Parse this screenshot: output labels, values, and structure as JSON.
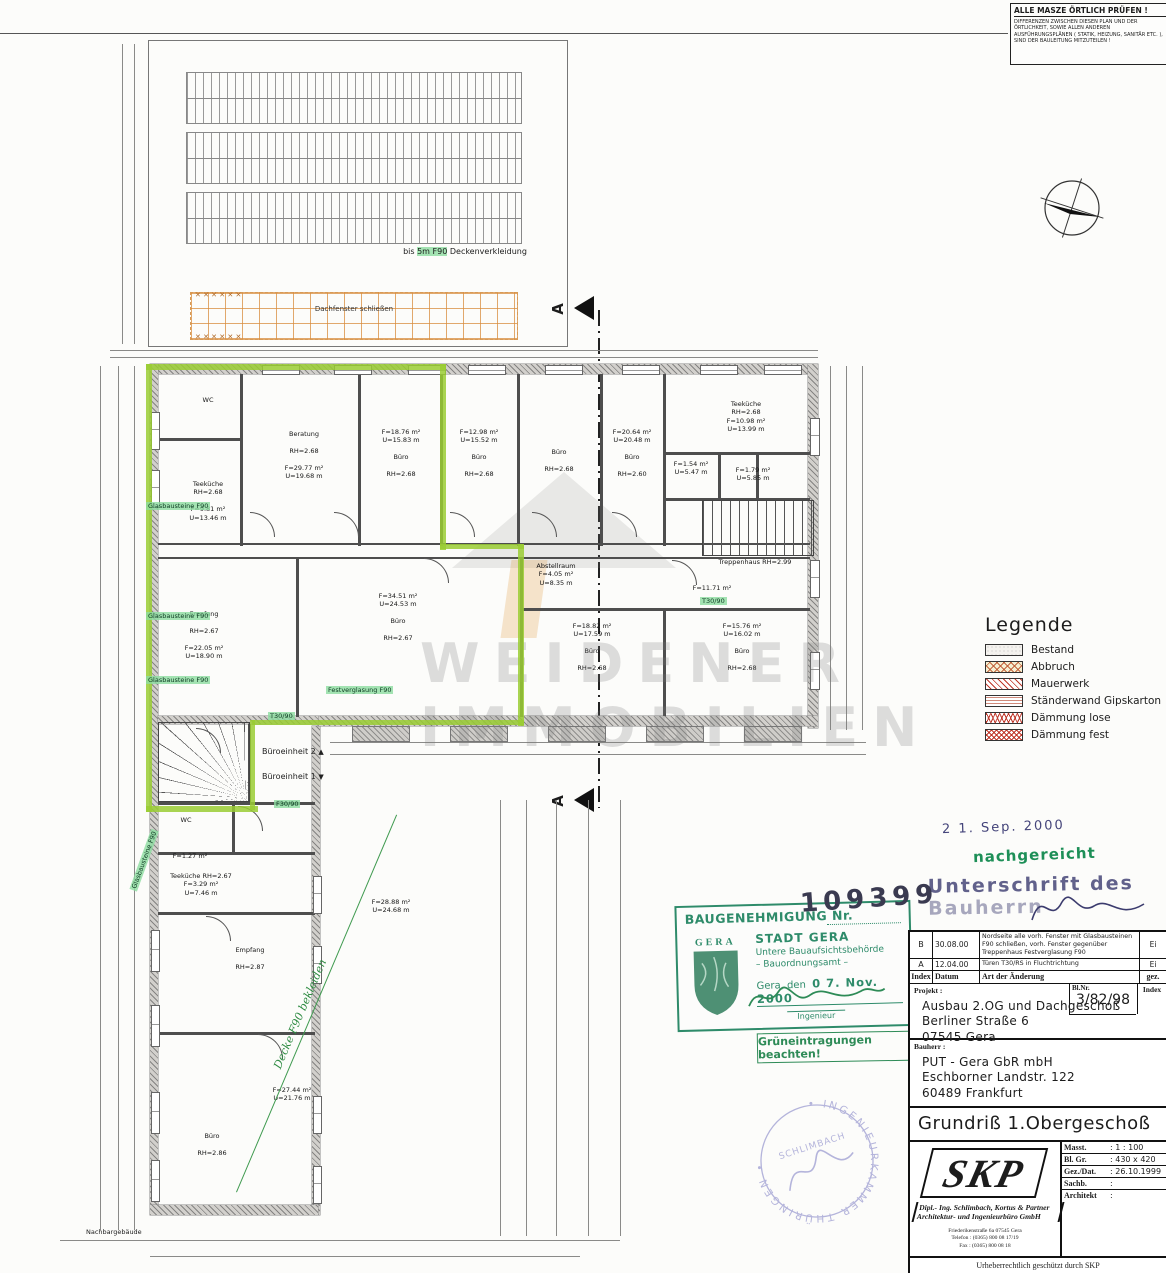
{
  "warning_box": {
    "title": "ALLE MASZE ÖRTLICH PRÜFEN !",
    "body": "DIFFERENZEN ZWISCHEN DIESEN PLAN UND DER ÖRTLICHKEIT, SOWIE ALLEN ANDEREN AUSFÜHRUNGSPLÄNEN ( STATIK, HEIZUNG, SANITÄR ETC. ), SIND DER BAULEITUNG MITZUTEILEN !"
  },
  "roof": {
    "note_pre": "bis ",
    "note_hl": "5m F90",
    "note_post": " Deckenverkleidung",
    "grid_label": "Dachfenster schließen",
    "x_row": "✕ ✕ ✕ ✕ ✕ ✕"
  },
  "section_marker": "A",
  "watermark": {
    "line1": "WEIDENER",
    "line2": "IMMOBILIEN"
  },
  "legend": {
    "title": "Legende",
    "items": [
      {
        "key": "bestand",
        "label": "Bestand"
      },
      {
        "key": "abbruch",
        "label": "Abbruch"
      },
      {
        "key": "mauerwerk",
        "label": "Mauerwerk"
      },
      {
        "key": "staender",
        "label": "Ständerwand Gipskarton"
      },
      {
        "key": "daemmlose",
        "label": "Dämmung lose"
      },
      {
        "key": "daemmfest",
        "label": "Dämmung fest"
      }
    ]
  },
  "plan": {
    "rooms": [
      {
        "x": 190,
        "y": 396,
        "w": 36,
        "lines": [
          "WC"
        ]
      },
      {
        "x": 172,
        "y": 480,
        "w": 72,
        "lines": [
          "Teeküche",
          "RH=2.68",
          "",
          "F=9.81 m²",
          "U=13.46 m"
        ]
      },
      {
        "x": 258,
        "y": 430,
        "w": 92,
        "lines": [
          "Beratung",
          "",
          "RH=2.68",
          "",
          "F=29.77 m²",
          "U=19.68 m"
        ]
      },
      {
        "x": 368,
        "y": 428,
        "w": 66,
        "lines": [
          "F=18.76 m²",
          "U=15.83 m",
          "",
          "Büro",
          "",
          "RH=2.68"
        ]
      },
      {
        "x": 446,
        "y": 428,
        "w": 66,
        "lines": [
          "F=12.98 m²",
          "U=15.52 m",
          "",
          "Büro",
          "",
          "RH=2.68"
        ]
      },
      {
        "x": 528,
        "y": 448,
        "w": 62,
        "lines": [
          "Büro",
          "",
          "RH=2.68"
        ]
      },
      {
        "x": 604,
        "y": 428,
        "w": 56,
        "lines": [
          "F=20.64 m²",
          "U=20.48 m",
          "",
          "Büro",
          "",
          "RH=2.60"
        ]
      },
      {
        "x": 700,
        "y": 400,
        "w": 92,
        "lines": [
          "Teeküche",
          "RH=2.68",
          "F=10.98 m²",
          "U=13.99 m"
        ]
      },
      {
        "x": 668,
        "y": 460,
        "w": 46,
        "lines": [
          "F=1.54 m²",
          "U=5.47 m"
        ]
      },
      {
        "x": 728,
        "y": 466,
        "w": 50,
        "lines": [
          "F=1.79 m²",
          "U=5.85 m"
        ]
      },
      {
        "x": 700,
        "y": 558,
        "w": 110,
        "lines": [
          "Treppenhaus   RH=2.99"
        ]
      },
      {
        "x": 680,
        "y": 584,
        "w": 64,
        "lines": [
          "F=11.71 m²"
        ]
      },
      {
        "x": 516,
        "y": 562,
        "w": 80,
        "lines": [
          "Abstellraum",
          "F=4.05 m²",
          "U=8.35 m"
        ]
      },
      {
        "x": 162,
        "y": 610,
        "w": 84,
        "lines": [
          "Empfang",
          "",
          "RH=2.67",
          "",
          "F=22.05 m²",
          "U=18.90 m"
        ]
      },
      {
        "x": 352,
        "y": 592,
        "w": 92,
        "lines": [
          "F=34.51 m²",
          "U=24.53 m",
          "",
          "Büro",
          "",
          "RH=2.67"
        ]
      },
      {
        "x": 552,
        "y": 622,
        "w": 80,
        "lines": [
          "F=18.82 m²",
          "U=17.59 m",
          "",
          "Büro",
          "",
          "RH=2.68"
        ]
      },
      {
        "x": 700,
        "y": 622,
        "w": 84,
        "lines": [
          "F=15.76 m²",
          "U=16.02 m",
          "",
          "Büro",
          "",
          "RH=2.68"
        ]
      },
      {
        "x": 168,
        "y": 816,
        "w": 36,
        "lines": [
          "WC"
        ]
      },
      {
        "x": 162,
        "y": 852,
        "w": 56,
        "lines": [
          "F=1.27 m²"
        ]
      },
      {
        "x": 158,
        "y": 872,
        "w": 86,
        "lines": [
          "Teeküche  RH=2.67",
          "F=3.29 m²",
          "U=7.46 m"
        ]
      },
      {
        "x": 352,
        "y": 898,
        "w": 78,
        "lines": [
          "F=28.88 m²",
          "U=24.68 m"
        ]
      },
      {
        "x": 212,
        "y": 946,
        "w": 76,
        "lines": [
          "Empfang",
          "",
          "RH=2.87"
        ]
      },
      {
        "x": 252,
        "y": 1086,
        "w": 80,
        "lines": [
          "F=27.44 m²",
          "U=21.76 m"
        ]
      },
      {
        "x": 182,
        "y": 1132,
        "w": 60,
        "lines": [
          "Büro",
          "",
          "RH=2.86"
        ]
      }
    ],
    "green_notes": [
      {
        "x": 146,
        "y": 502,
        "t": "Glasbausteine F90"
      },
      {
        "x": 146,
        "y": 612,
        "t": "Glasbausteine F90"
      },
      {
        "x": 146,
        "y": 676,
        "t": "Glasbausteine F90"
      },
      {
        "x": 326,
        "y": 686,
        "t": "Festverglasung F90"
      },
      {
        "x": 268,
        "y": 712,
        "t": "T30/90"
      },
      {
        "x": 700,
        "y": 597,
        "t": "T30/90"
      },
      {
        "x": 274,
        "y": 800,
        "t": "F30/90"
      },
      {
        "x": 112,
        "y": 856,
        "t": "Glasbausteine F90",
        "rot": -70
      }
    ],
    "unit_labels": [
      {
        "label": "Büroeinheit 2",
        "arrow": "▲",
        "x": 262,
        "y": 747
      },
      {
        "label": "Büroeinheit 1",
        "arrow": "▼",
        "x": 262,
        "y": 772
      }
    ],
    "diag_note": "Decke F90 bekleiden",
    "neighbor_label": "Nachbargebäude"
  },
  "stamps": {
    "date_received": "2 1. Sep. 2000",
    "nachgereicht": "nachgereicht",
    "unterschrift_line1": "Unterschrift des",
    "unterschrift_line2": "Bauherrn",
    "baugenehmigung": {
      "title": "BAUGENEHMIGUNG Nr.",
      "number": "109399",
      "shield_caption": "G E R A",
      "line1": "STADT GERA",
      "line2": "Untere Bauaufsichtsbehörde",
      "line3": "– Bauordnungsamt –",
      "date_prefix": "Gera, den",
      "date": "0 7. Nov. 2000",
      "role": "Ingenieur"
    },
    "gruen_note": "Grüneintragungen beachten!",
    "seal_ring": "INGENIEURKAMMER THÜRINGEN",
    "seal_name": "SCHLIMBACH"
  },
  "revision": {
    "rows": [
      {
        "index": "B",
        "datum": "30.08.00",
        "text": "Nordseite alle vorh. Fenster mit Glasbausteinen F90 schließen, vorh. Fenster gegenüber Treppenhaus Festverglasung F90",
        "gez": "Ei"
      },
      {
        "index": "A",
        "datum": "12.04.00",
        "text": "Türen T30/RS in Fluchtrichtung",
        "gez": "Ei"
      }
    ],
    "header": {
      "index": "Index",
      "datum": "Datum",
      "text": "Art der Änderung",
      "gez": "gez."
    }
  },
  "title_block": {
    "projekt_label": "Projekt :",
    "projekt_lines": [
      "Ausbau 2.OG und Dachgeschoß",
      "Berliner Straße 6",
      "07545 Gera"
    ],
    "blnr_label": "Bl.Nr.",
    "blnr_value": "3/82/98",
    "index_label": "Index",
    "bauherr_label": "Bauherr :",
    "bauherr_lines": [
      "PUT - Gera GbR mbH",
      "Eschborner Landstr. 122",
      "60489 Frankfurt"
    ],
    "drawing_title": "Grundriß 1.Obergeschoß",
    "logo_text": "SKP",
    "firm_line1": "Dipl.- Ing. Schlimbach, Kortus & Partner",
    "firm_line2": "Architektur-  und Ingenieurbüro GmbH",
    "address_lines": [
      "Friederikenstraße 6a   07545 Gera",
      "Telefon : (0365) 800 08 17/19",
      "Fax :       (0365) 800 08 18"
    ],
    "fields": [
      {
        "label": "Masst.",
        "value": ":   1 : 100"
      },
      {
        "label": "Bl. Gr.",
        "value": ":   430 x 420"
      },
      {
        "label": "Gez./Dat.",
        "value": ":   26.10.1999"
      },
      {
        "label": "Sachb.",
        "value": ":"
      },
      {
        "label": "Architekt",
        "value": ":"
      }
    ],
    "copyright": "Urheberrechtlich geschützt durch SKP"
  }
}
